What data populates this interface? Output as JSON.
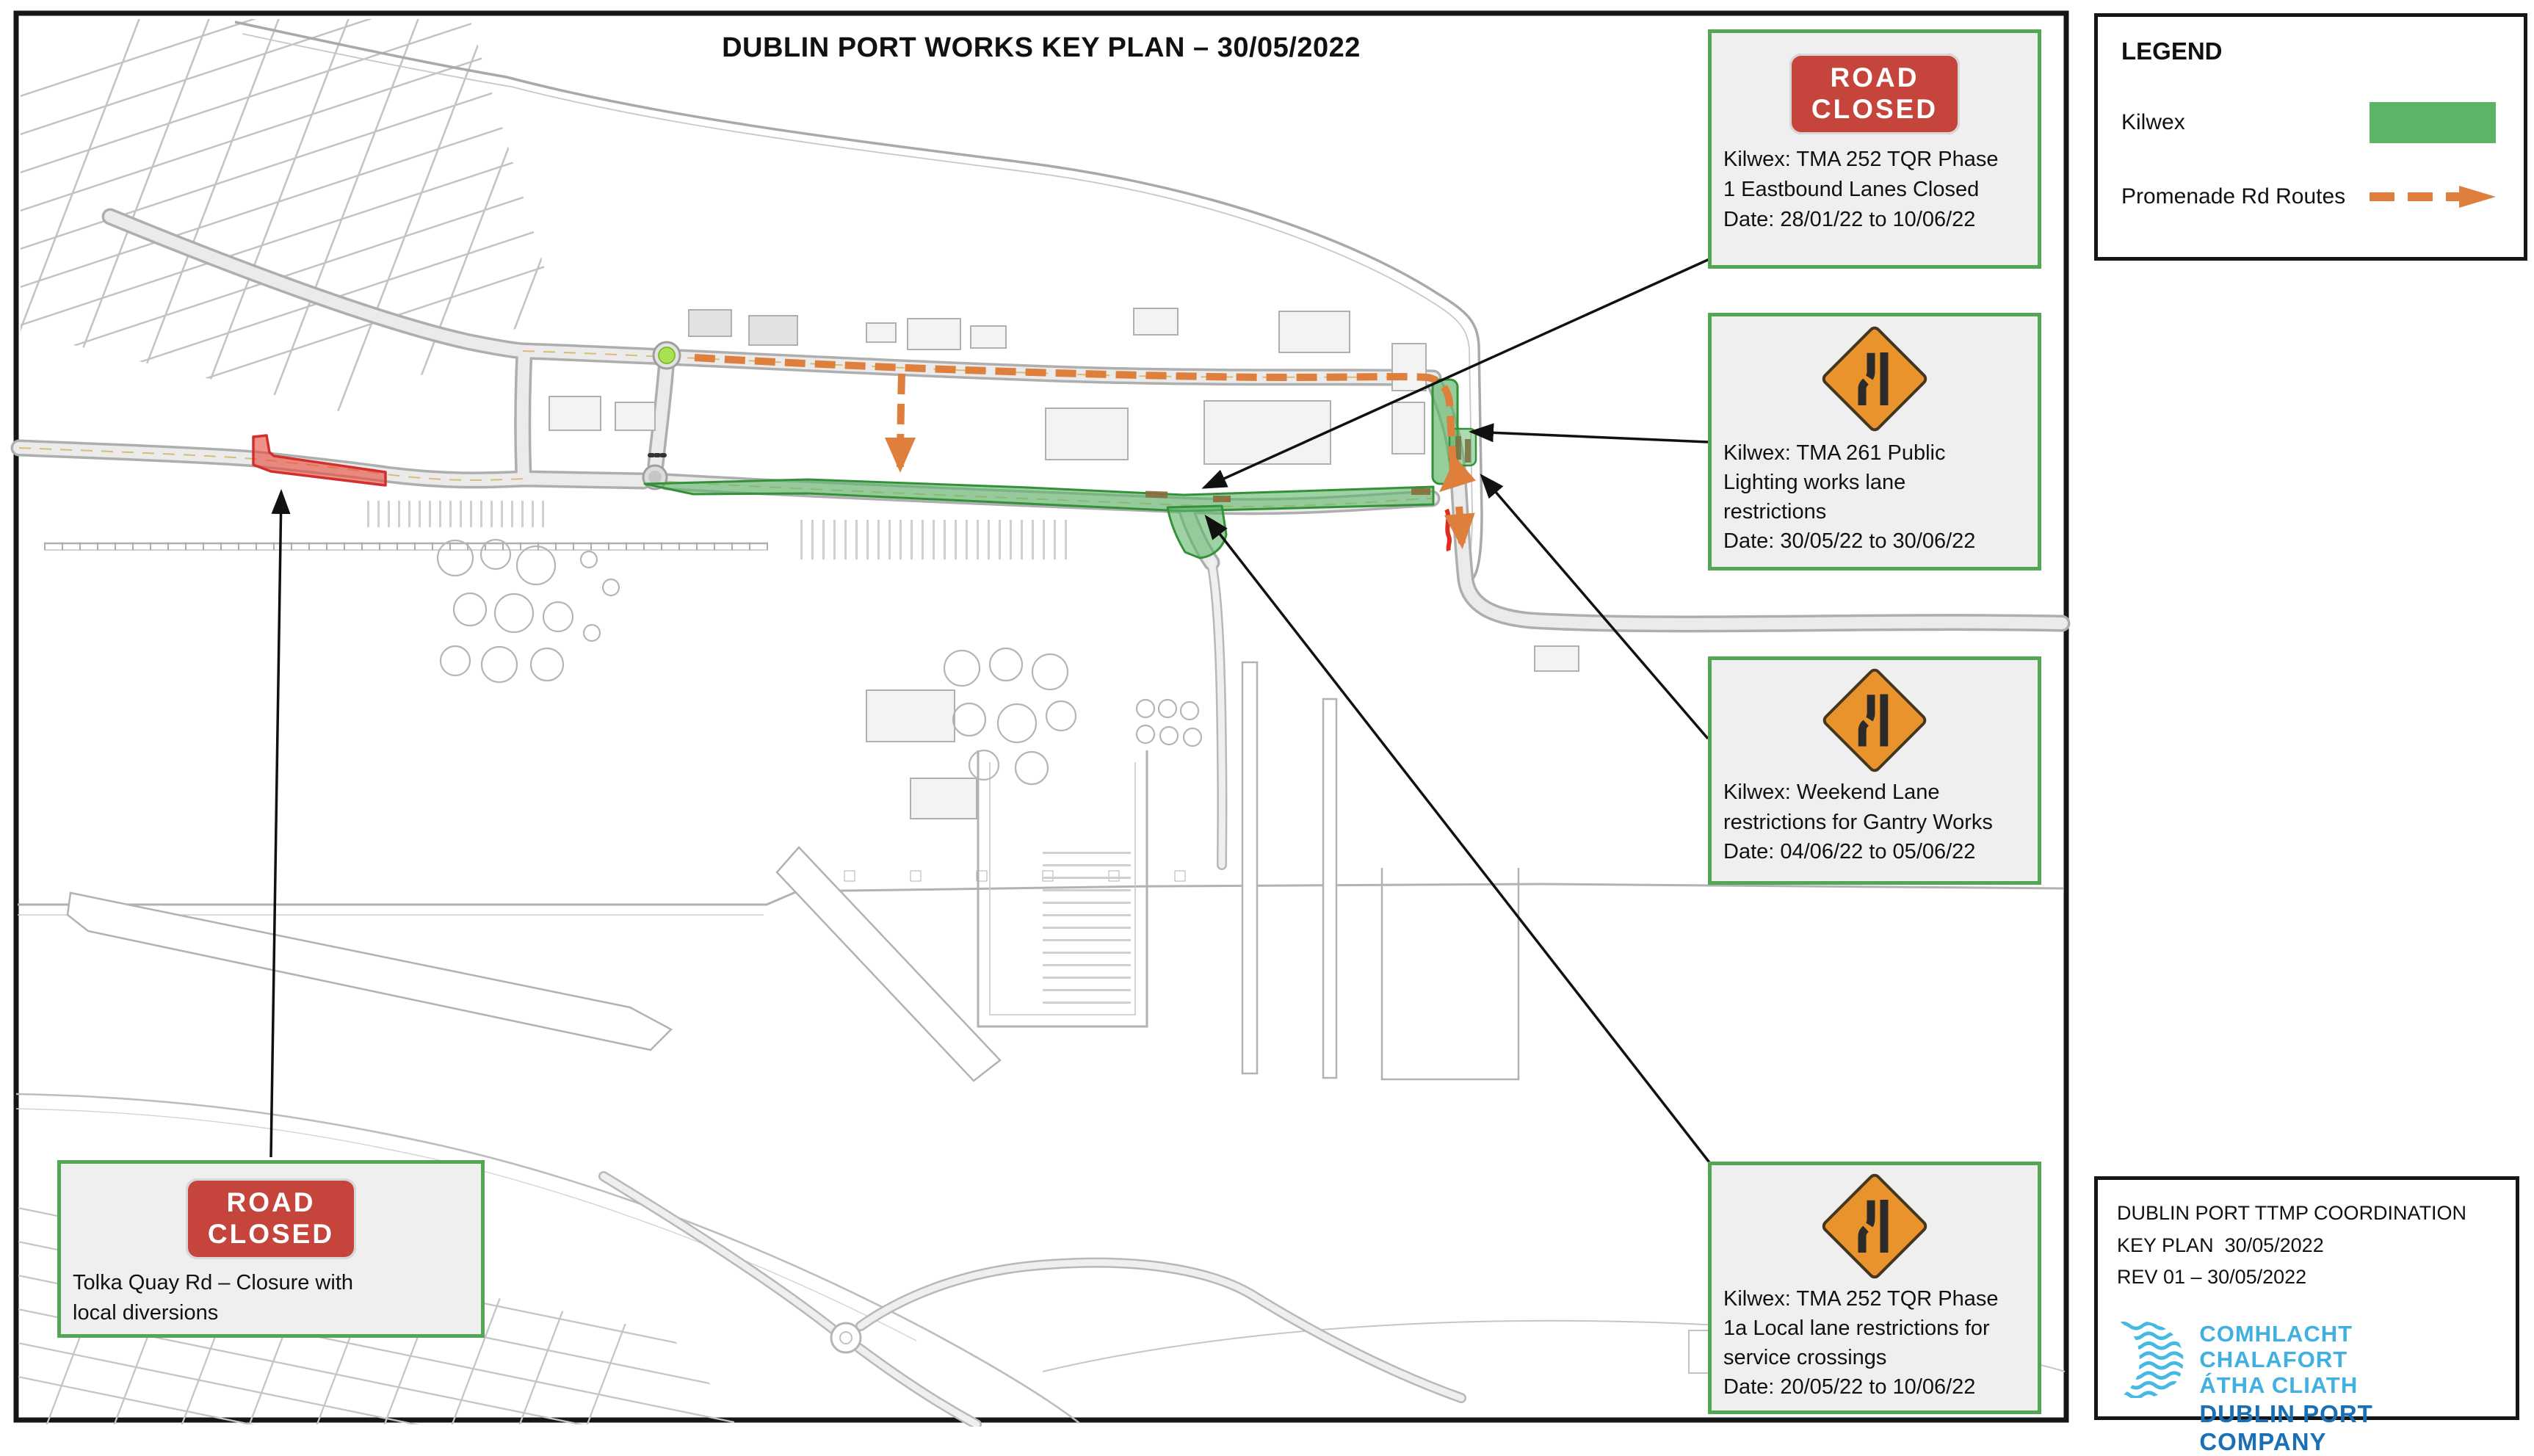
{
  "title": "DUBLIN PORT WORKS KEY PLAN – 30/05/2022",
  "legend": {
    "heading": "LEGEND",
    "items": {
      "kilwex": {
        "label": "Kilwex",
        "color": "#5cb567"
      },
      "promenade": {
        "label": "Promenade Rd Routes",
        "color": "#df7f3d"
      }
    }
  },
  "callouts": {
    "tma252_phase1": {
      "sign": "ROAD\nCLOSED",
      "text": "Kilwex: TMA 252 TQR Phase\n1 Eastbound Lanes Closed\nDate: 28/01/22 to 10/06/22"
    },
    "tma261": {
      "text": "Kilwex: TMA 261 Public\nLighting works lane\nrestrictions\nDate: 30/05/22 to 30/06/22"
    },
    "gantry_weekend": {
      "text": "Kilwex: Weekend Lane\nrestrictions for Gantry Works\nDate: 04/06/22 to 05/06/22"
    },
    "tma252_phase1a": {
      "text": "Kilwex: TMA 252 TQR Phase\n1a Local lane restrictions for\nservice crossings\nDate: 20/05/22 to 10/06/22"
    },
    "tolka_quay": {
      "sign": "ROAD\nCLOSED",
      "text": "Tolka Quay Rd – Closure with\nlocal diversions"
    }
  },
  "title_block": {
    "line1": "DUBLIN PORT TTMP COORDINATION",
    "line2": "KEY PLAN  30/05/2022",
    "line3": "REV 01 – 30/05/2022",
    "logo": {
      "line1": "COMHLACHT CHALAFORT",
      "line2": "ÁTHA CLIATH",
      "line3": "DUBLIN PORT COMPANY"
    }
  },
  "colors": {
    "kilwex_green": "#5cb567",
    "route_orange": "#df7f3d",
    "closure_red": "#e74c3c",
    "sign_red": "#c5443c",
    "callout_border_green": "#53a653",
    "roundabout_green": "#a8e34f",
    "logo_light_blue": "#3fb0e0",
    "logo_dark_blue": "#1b6fb5"
  }
}
